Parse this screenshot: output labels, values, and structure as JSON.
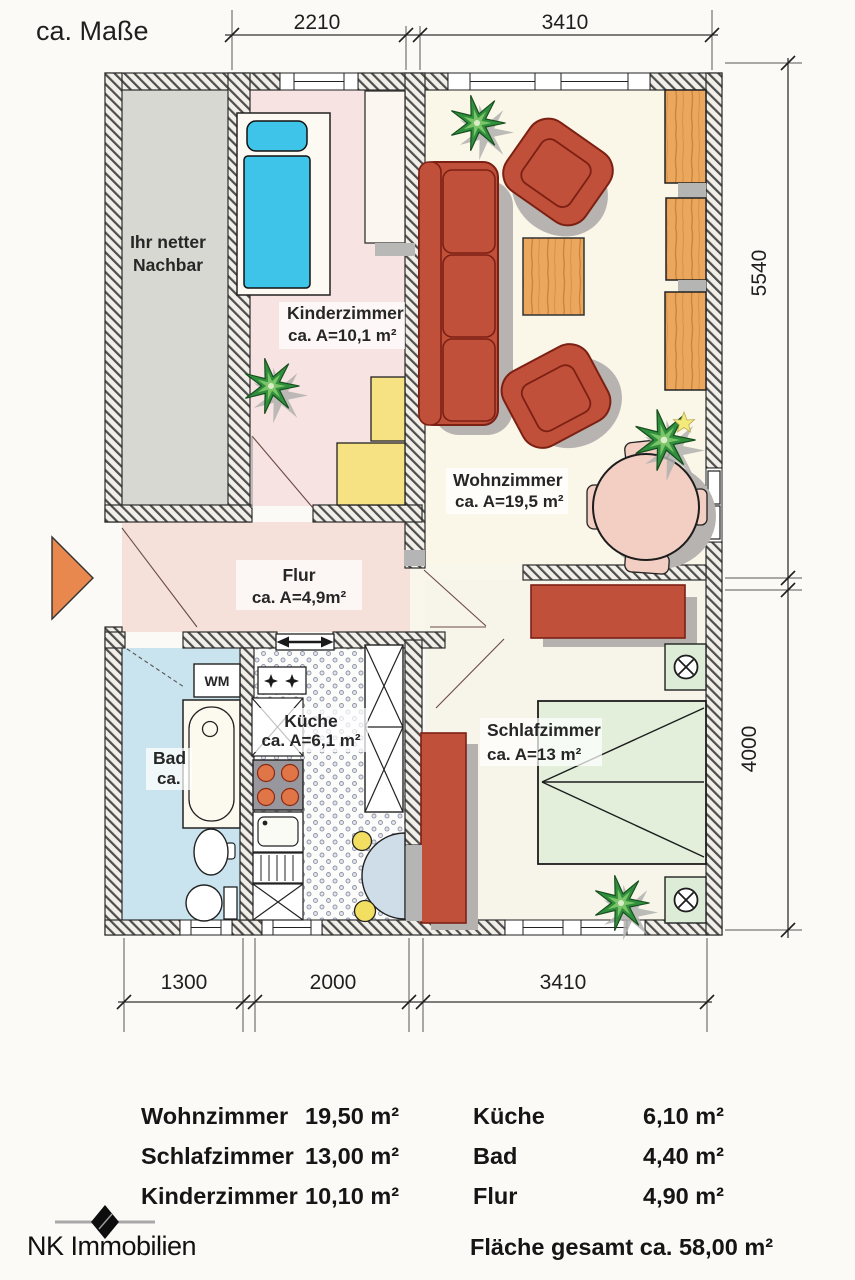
{
  "page": {
    "scale_note": "ca. Maße"
  },
  "dims": {
    "top1": "2210",
    "top2": "3410",
    "right1": "5540",
    "right2": "4000",
    "bottom1": "1300",
    "bottom2": "2000",
    "bottom3": "3410"
  },
  "rooms": {
    "neighbor_line1": "Ihr netter",
    "neighbor_line2": "Nachbar",
    "kinderzimmer_name": "Kinderzimmer",
    "kinderzimmer_area": "ca. A=10,1 m²",
    "wohnzimmer_name": "Wohnzimmer",
    "wohnzimmer_area": "ca. A=19,5 m²",
    "flur_name": "Flur",
    "flur_area": "ca. A=4,9m²",
    "kueche_name": "Küche",
    "kueche_area": "ca. A=6,1 m²",
    "bad_name": "Bad",
    "bad_area": "ca.",
    "schlafzimmer_name": "Schlafzimmer",
    "schlafzimmer_area": "ca. A=13 m²",
    "washing_machine": "WM"
  },
  "area_table": {
    "left": [
      {
        "room": "Wohnzimmer",
        "area": "19,50 m²"
      },
      {
        "room": "Schlafzimmer",
        "area": "13,00 m²"
      },
      {
        "room": "Kinderzimmer",
        "area": "10,10 m²"
      }
    ],
    "right": [
      {
        "room": "Küche",
        "area": "6,10 m²"
      },
      {
        "room": "Bad",
        "area": "4,40 m²"
      },
      {
        "room": "Flur",
        "area": "4,90 m²"
      }
    ],
    "total": "Fläche gesamt ca. 58,00 m²"
  },
  "footer": {
    "brand": "NK Immobilien"
  },
  "colors": {
    "wall_hatch": "#4e4e4e",
    "neighbor_floor": "#d6d8d1",
    "kinderzimmer_floor": "#f7e3e2",
    "wohnzimmer_floor": "#faf6e8",
    "flur_floor": "#f5e1da",
    "bad_floor": "#c9e4ee",
    "schlafzimmer_floor": "#f7f4ea",
    "red_furniture": "#c1503a",
    "wood": "#eca75f",
    "yellow_furniture": "#f6e183",
    "bed_blue": "#3ec4e9",
    "bed_green": "#e3efdb",
    "table_pink": "#f3cfc3",
    "arrow_orange": "#e8884e"
  }
}
